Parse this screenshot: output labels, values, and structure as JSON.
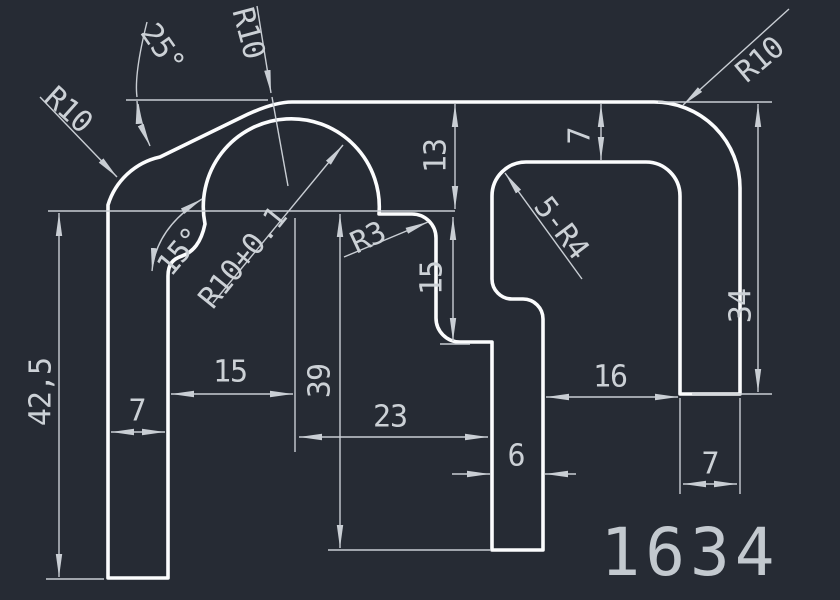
{
  "title": "CAD profile drawing",
  "part_number": "1634",
  "colors": {
    "background": "#262b34",
    "outline": "#fbfcfd",
    "dimension": "#c9ced4",
    "text": "#ccd1d6"
  },
  "dims": {
    "angle_25": "25°",
    "r10_top": "R10",
    "r10_left": "R10",
    "r10_right": "R10",
    "angle_15": "15°",
    "arch_radius": "R10+0.1",
    "r3": "R3",
    "slot_radii": "5-R4",
    "v13": "13",
    "v15": "15",
    "v7_top": "7",
    "v34": "34",
    "v39": "39",
    "v42_5": "42,5",
    "h7_left": "7",
    "h15": "15",
    "h23": "23",
    "h6": "6",
    "h16": "16",
    "h7_right": "7"
  }
}
